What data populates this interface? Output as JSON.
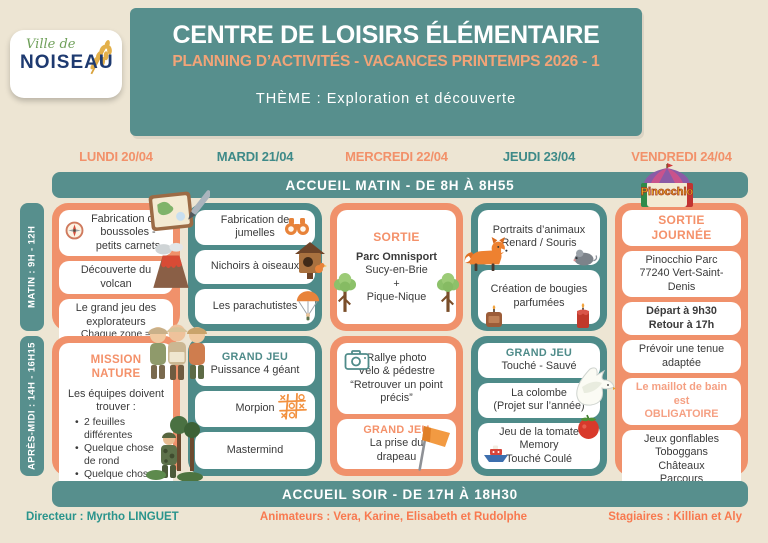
{
  "logo": {
    "script": "Ville de",
    "name": "NOISEAU"
  },
  "header": {
    "title": "CENTRE DE LOISIRS ÉLÉMENTAIRE",
    "subtitle": "PLANNING D’ACTIVITÉS - VACANCES PRINTEMPS 2026 - 1",
    "theme": "THÈME : Exploration et découverte"
  },
  "days": {
    "monday": "LUNDI 20/04",
    "tuesday": "MARDI 21/04",
    "wednesday": "MERCREDI 22/04",
    "thursday": "JEUDI 23/04",
    "friday": "VENDREDI 24/04"
  },
  "banners": {
    "morning": "ACCUEIL MATIN - DE 8H À 8H55",
    "evening": "ACCUEIL SOIR - DE 17H À 18H30"
  },
  "schedule_tabs": {
    "morning": "MATIN : 9H - 12H",
    "afternoon": "APRÈS-MIDI : 14H - 16H15"
  },
  "pinocchio_logo_text": "Pinocchio",
  "cells": {
    "monday_morning": {
      "card1": "Fabrication des boussoles - petits carnets",
      "card2": "Découverte du volcan",
      "card3_line1": "Le grand jeu des explorateurs",
      "card3_line2": "Chaque zone = mission"
    },
    "tuesday_morning": {
      "card1": "Fabrication de jumelles",
      "card2": "Nichoirs à oiseaux",
      "card3": "Les parachutistes"
    },
    "wednesday_morning": {
      "heading": "SORTIE",
      "line1": "Parc Omnisport",
      "line2": "Sucy-en-Brie",
      "line3": "+",
      "line4": "Pique-Nique"
    },
    "thursday_morning": {
      "card1_line1": "Portraits d’animaux",
      "card1_line2": "Renard / Souris",
      "card2_line1": "Création de bougies",
      "card2_line2": "parfumées"
    },
    "friday": {
      "heading": "SORTIE JOURNÉE",
      "card2_line1": "Pinocchio Parc",
      "card2_line2": "77240 Vert-Saint-Denis",
      "card3_line1": "Départ à 9h30",
      "card3_line2": "Retour à 17h",
      "card4_line1": "Prévoir une tenue",
      "card4_line2": "adaptée",
      "card5_line1": "Le maillot de bain est",
      "card5_line2": "OBLIGATOIRE",
      "card6_line1": "Jeux gonflables",
      "card6_line2": "Toboggans",
      "card6_line3": "Châteaux",
      "card6_line4": "Parcours"
    },
    "monday_afternoon": {
      "heading": "MISSION NATURE",
      "intro_line1": "Les équipes doivent",
      "intro_line2": "trouver :",
      "bullet1": "2 feuilles différentes",
      "bullet2": "Quelque chose de rond",
      "bullet3": "Quelque chose de vert"
    },
    "tuesday_afternoon": {
      "card1_heading": "GRAND JEU",
      "card1_text": "Puissance 4 géant",
      "card2": "Morpion",
      "card3": "Mastermind"
    },
    "wednesday_afternoon": {
      "card1_line1": "Rallye photo",
      "card1_line2": "Vélo & pédestre",
      "card1_line3": "“Retrouver un point",
      "card1_line4": "précis”",
      "card2_heading": "GRAND JEU",
      "card2_line1": "La prise du",
      "card2_line2": "drapeau"
    },
    "thursday_afternoon": {
      "card1_heading": "GRAND JEU",
      "card1_text": "Touché - Sauvé",
      "card2_line1": "La colombe",
      "card2_line2": "(Projet sur l’année)",
      "card3_line1": "Jeu de la tomate",
      "card3_line2": "Memory",
      "card3_line3": "Touché Coulé"
    }
  },
  "footer": {
    "director": "Directeur : Myrtho LINGUET",
    "animators": "Animateurs : Vera, Karine, Elisabeth et Rudolphe",
    "trainees": "Stagiaires : Killian et Aly"
  },
  "colors": {
    "teal": "#578f8d",
    "orange": "#f0916b",
    "cream": "#ede5d3",
    "accent_orange": "#f4916a",
    "navy": "#1e3a70"
  }
}
